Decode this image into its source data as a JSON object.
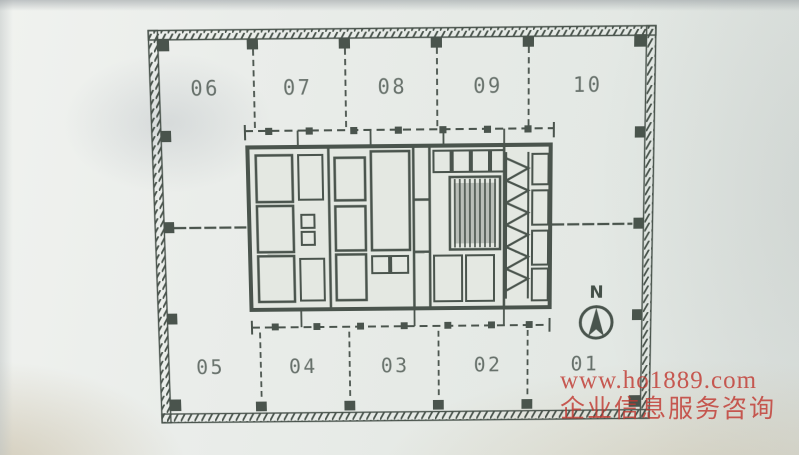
{
  "units": {
    "top": [
      "06",
      "07",
      "08",
      "09",
      "10"
    ],
    "bottom": [
      "05",
      "04",
      "03",
      "02",
      "01"
    ]
  },
  "compass": {
    "label": "N"
  },
  "watermark": {
    "line1": "www.ho1889.com",
    "line2": "企业信息服务咨询",
    "color": "#c13a32"
  },
  "colors": {
    "ink": "#3e4941",
    "paper": "#e6eae5",
    "core_fill": "#e3e8e1"
  }
}
